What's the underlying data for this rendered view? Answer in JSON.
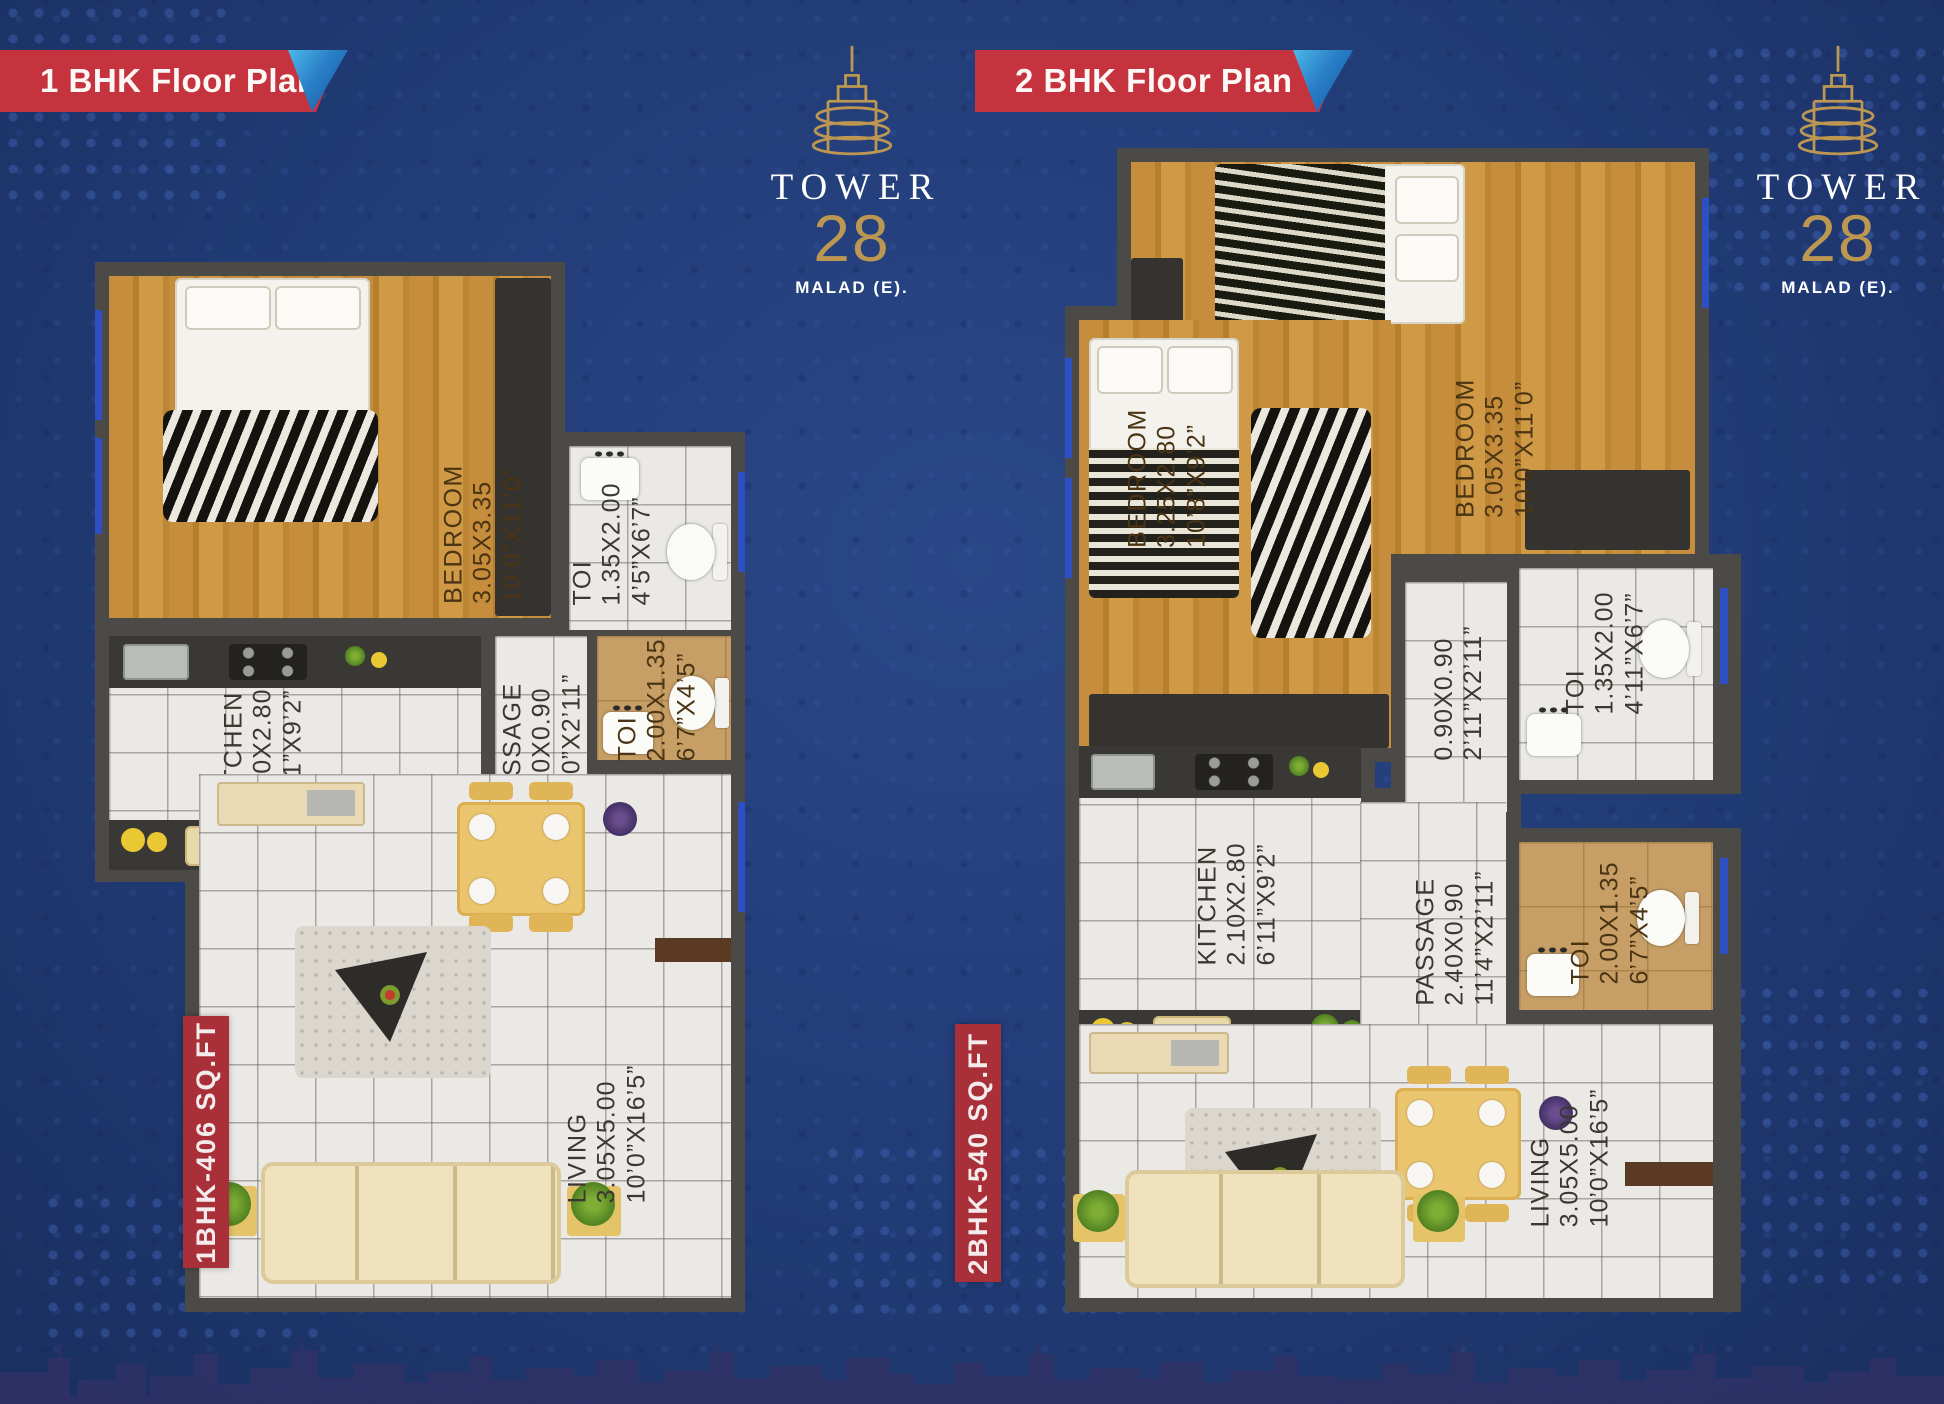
{
  "banners": [
    {
      "label": "1 BHK Floor Plan"
    },
    {
      "label": "2 BHK Floor Plan"
    }
  ],
  "logo": {
    "name": "TOWER",
    "number": "28",
    "location": "MALAD (E)."
  },
  "plans": [
    {
      "id": "1bhk",
      "tag": "1BHK-406 SQ.FT",
      "rooms": [
        {
          "name": "BEDROOM",
          "metric": "3.05X3.35",
          "imperial": "10’0”X11’0”"
        },
        {
          "name": "TOI",
          "metric": "1.35X2.00",
          "imperial": "4’5”X6’7”"
        },
        {
          "name": "KITCHEN",
          "metric": "2.10X2.80",
          "imperial": "6’11”X9’2”"
        },
        {
          "name": "PASSAGE",
          "metric": "2.40X0.90",
          "imperial": "7’10”X2’11”"
        },
        {
          "name": "TOI",
          "metric": "2.00X1.35",
          "imperial": "6’7”X4’5”"
        },
        {
          "name": "LIVING",
          "metric": "3.05X5.00",
          "imperial": "10’0”X16’5”"
        }
      ]
    },
    {
      "id": "2bhk",
      "tag": "2BHK-540 SQ.FT",
      "rooms": [
        {
          "name": "BEDROOM",
          "metric": "3.25X2.80",
          "imperial": "10’8”X9’2”"
        },
        {
          "name": "BEDROOM",
          "metric": "3.05X3.35",
          "imperial": "10’0”X11’0”"
        },
        {
          "name": "",
          "metric": "0.90X0.90",
          "imperial": "2’11”X2’11”"
        },
        {
          "name": "TOI",
          "metric": "1.35X2.00",
          "imperial": "4’11”X6’7”"
        },
        {
          "name": "KITCHEN",
          "metric": "2.10X2.80",
          "imperial": "6’11”X9’2”"
        },
        {
          "name": "PASSAGE",
          "metric": "2.40X0.90",
          "imperial": "11’4”X2’11”"
        },
        {
          "name": "TOI",
          "metric": "2.00X1.35",
          "imperial": "6’7”X4’5”"
        },
        {
          "name": "LIVING",
          "metric": "3.05X5.00",
          "imperial": "10’0”X16’5”"
        }
      ]
    }
  ],
  "colors": {
    "background_blue": "#213b75",
    "banner_red": "#c5333f",
    "tag_red": "#a93038",
    "gold": "#bb9752",
    "wall_gray": "#4b4a47",
    "window_blue": "#2d4fc2",
    "skyline_navy": "#2e3166"
  }
}
